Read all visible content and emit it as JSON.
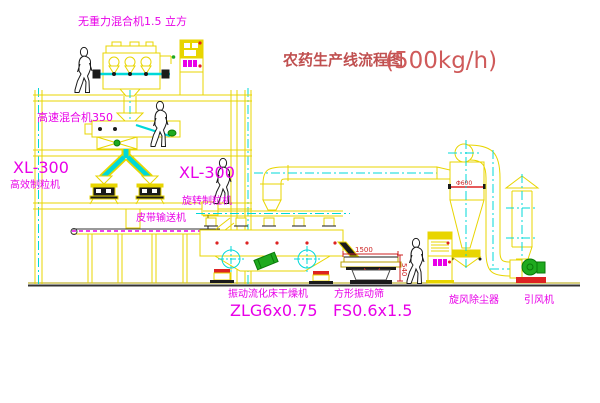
{
  "title": {
    "text": "农药生产线流程图",
    "capacity": "(500kg/h)"
  },
  "labels": {
    "gravity_mixer": "无重力混合机1.5 立方",
    "high_speed_mixer": "高速混合机350",
    "granulator_left": {
      "model": "XL-300",
      "name": "高效制粒机"
    },
    "granulator_center": {
      "model": "XL-300",
      "name": "旋转制粒机"
    },
    "belt_conveyor": "皮带输送机",
    "dryer": {
      "name": "振动流化床干燥机",
      "model": "ZLG6x0.75"
    },
    "screen": {
      "name": "方形振动筛",
      "model": "FS0.6x1.5"
    },
    "cyclone": "旋风除尘器",
    "fan": "引风机"
  },
  "dimensions": {
    "screen_length": "1500",
    "screen_height": "540",
    "cyclone_diameter": "Φ600"
  },
  "colors": {
    "line_yellow": "#e8d500",
    "centerline_cyan": "#00d8d8",
    "label_magenta": "#e800e8",
    "accent_red": "#dd2222",
    "title_red": "#c05050",
    "machine_green": "#1faa1f",
    "figure_black": "#1a1a1a",
    "background": "#ffffff"
  }
}
